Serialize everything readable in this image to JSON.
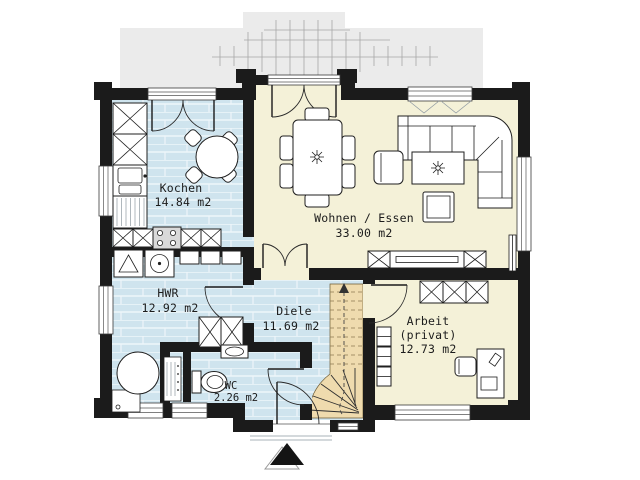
{
  "plan_type": "residential-ground-floor-plan",
  "rooms": {
    "kochen": {
      "name": "Kochen",
      "area": "14.84 m2"
    },
    "wohnen_essen": {
      "name": "Wohnen / Essen",
      "area": "33.00 m2"
    },
    "hwr": {
      "name": "HWR",
      "area": "12.92 m2"
    },
    "diele": {
      "name": "Diele",
      "area": "11.69 m2"
    },
    "wc": {
      "name": "WC",
      "area": "2.26 m2"
    },
    "arbeit": {
      "name": "Arbeit",
      "qualifier": "(privat)",
      "area": "12.73 m2"
    }
  },
  "colors": {
    "wall": "#1b1b1b",
    "wet_room_floor": "#cfe4ee",
    "living_floor": "#f4f1d8",
    "stair_fill": "#efdbae",
    "terrace": "#ebebeb",
    "background": "#ffffff"
  },
  "icons": [
    "double-terrace-door-icon",
    "single-door-icon",
    "window-icon",
    "winder-stair-icon",
    "walking-line-arrow-icon",
    "entrance-arrow-icon",
    "round-kitchen-table-icon",
    "chair-icon",
    "tall-cabinet-icon",
    "kitchen-sink-icon",
    "dishwasher-icon",
    "stove-icon",
    "base-cabinet-icon",
    "washing-machine-icon",
    "tumble-dryer-icon",
    "boiler-icon",
    "heating-manifold-icon",
    "wardrobe-icon",
    "toilet-icon",
    "washbasin-icon",
    "dining-table-icon",
    "plant-icon",
    "corner-sofa-icon",
    "armchair-icon",
    "coffee-table-icon",
    "stool-icon",
    "sideboard-tv-icon",
    "desk-icon",
    "desk-chair-icon",
    "shelf-icon",
    "radiator-icon",
    "pergola-trellis-icon"
  ]
}
